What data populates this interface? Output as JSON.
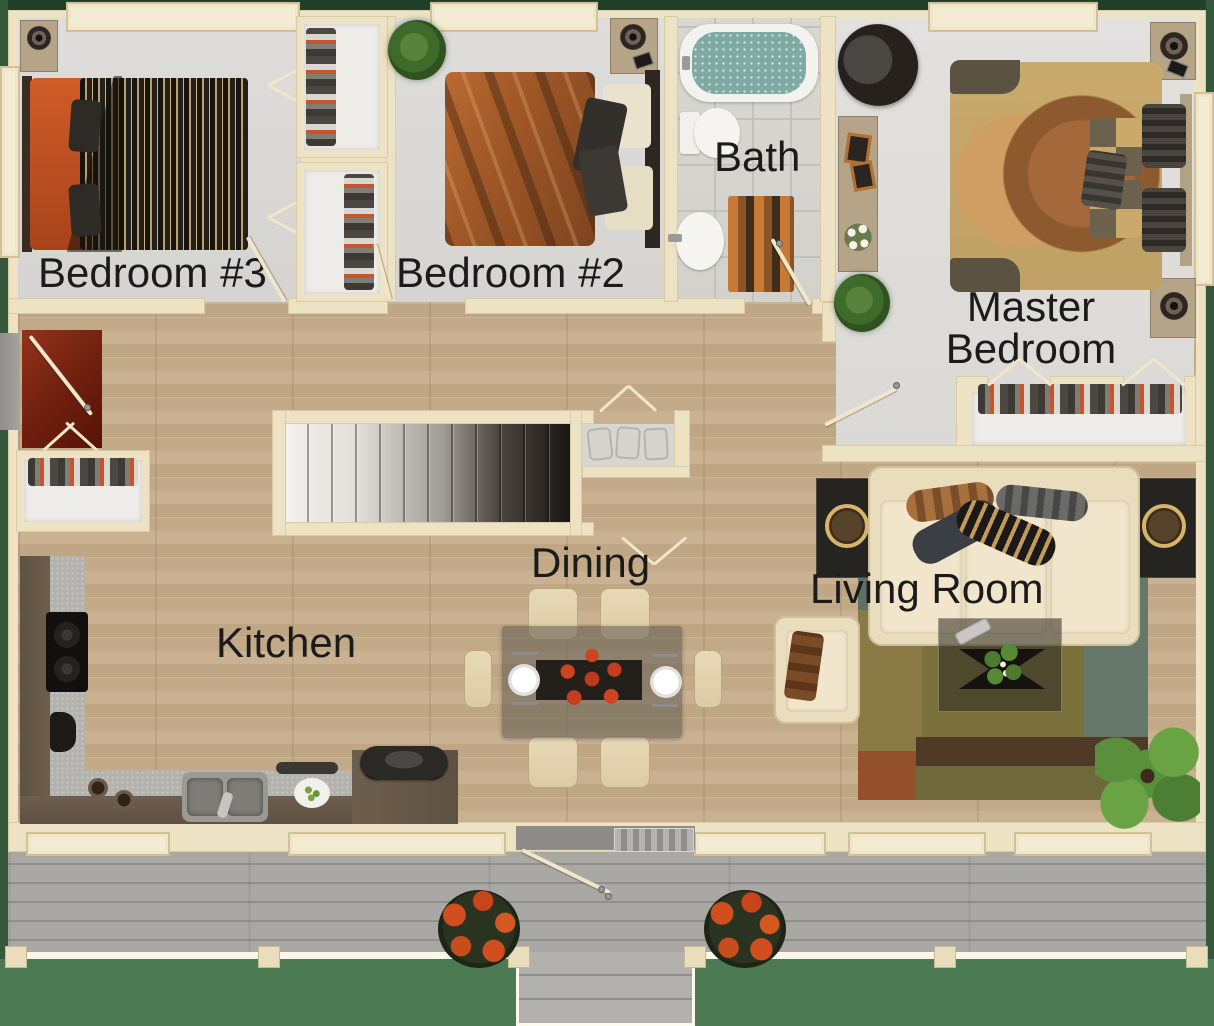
{
  "rooms": [
    {
      "id": "bedroom-3",
      "label": "Bedroom #3",
      "furniture": [
        "double-bed",
        "nightstand-speaker",
        "shoe-closets"
      ]
    },
    {
      "id": "bedroom-2",
      "label": "Bedroom #2",
      "furniture": [
        "double-bed",
        "nightstand-speaker",
        "potted-plant"
      ]
    },
    {
      "id": "bath",
      "label": "Bath",
      "furniture": [
        "bathtub",
        "toilet",
        "sink",
        "bath-mat"
      ]
    },
    {
      "id": "master-bedroom",
      "label": "Master Bedroom",
      "furniture": [
        "king-bed",
        "two-nightstand-speakers",
        "papasan-chair",
        "console-table",
        "potted-plant",
        "shoe-closet"
      ]
    },
    {
      "id": "dining",
      "label": "Dining",
      "furniture": [
        "dining-table",
        "six-chairs",
        "place-settings",
        "flower-centerpiece"
      ]
    },
    {
      "id": "kitchen",
      "label": "Kitchen",
      "furniture": [
        "l-shaped-counter",
        "cooktop",
        "coffee-maker",
        "double-sink",
        "serving-dishes"
      ]
    },
    {
      "id": "living-room",
      "label": "Living Room",
      "furniture": [
        "sofa",
        "armchair",
        "coffee-table",
        "two-side-tables",
        "area-rug",
        "palm-plant"
      ]
    }
  ],
  "outdoor": {
    "deck_features": [
      "wood-deck",
      "railing",
      "front-steps",
      "two-flower-pots",
      "front-door",
      "entry-landing"
    ],
    "staircase": "interior-staircase"
  },
  "colors": {
    "grass": "#4c7a53",
    "wall": "#eee2c4",
    "wood_floor": "#c4ab8b",
    "bedroom_carpet": "#dbdad7",
    "deck": "#a5a4a0",
    "label_text": "#1b1b1b",
    "accent_orange": "#c05020",
    "water": "#7fa9a3"
  }
}
